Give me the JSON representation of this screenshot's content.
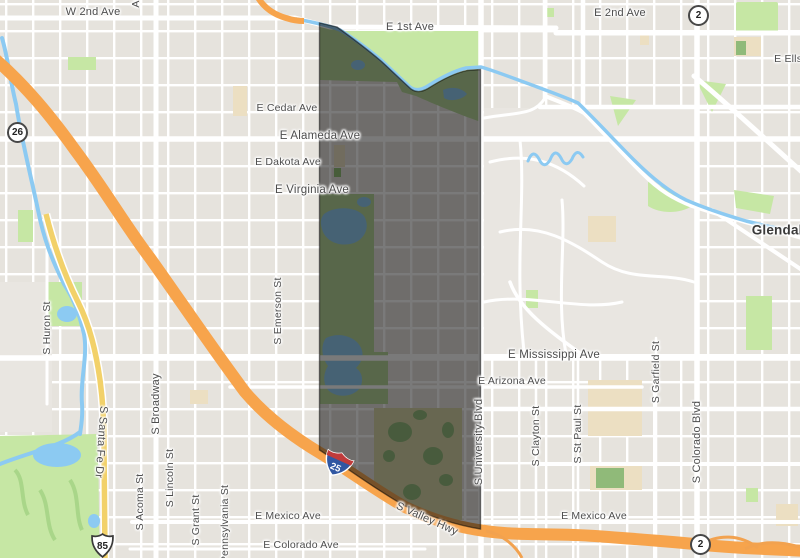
{
  "map": {
    "region_label": "highlighted neighborhood boundary",
    "colors": {
      "land": "#e6e3dd",
      "road": "#ffffff",
      "park": "#c6e7a4",
      "park_dark": "#b3d594",
      "water": "#8ccaf2",
      "highway_orange": "#f7a44c",
      "road_yellow": "#f2d169",
      "school_tan": "#ecdfc2",
      "golf_tan": "#d8d4a4",
      "overlay": "#0d0d0d",
      "label_text": "#4d4d4d"
    },
    "shields": {
      "state_26": {
        "number": "26"
      },
      "state_2_north": {
        "number": "2"
      },
      "state_2_south": {
        "number": "2"
      },
      "us_85": {
        "number": "85"
      },
      "interstate_25": {
        "number": "25"
      }
    },
    "labels": [
      {
        "t": "W 2nd Ave",
        "x": 93,
        "y": 12,
        "r": 0,
        "s": 11
      },
      {
        "t": "Acoma St",
        "x": 136,
        "y": -16,
        "r": -90,
        "s": 10.5
      },
      {
        "t": "E 1st Ave",
        "x": 410,
        "y": 27,
        "r": 0,
        "s": 11
      },
      {
        "t": "E 2nd Ave",
        "x": 620,
        "y": 13,
        "r": 0,
        "s": 11
      },
      {
        "t": "E Ellsworth Ave",
        "x": 812,
        "y": 59,
        "r": 0,
        "s": 10.5
      },
      {
        "t": "E Cedar Ave",
        "x": 287,
        "y": 108,
        "r": 0,
        "s": 10.5
      },
      {
        "t": "E Cedar Ave",
        "x": 832,
        "y": 107,
        "r": 0,
        "s": 10.5
      },
      {
        "t": "E Alameda Ave",
        "x": 320,
        "y": 136,
        "r": 0,
        "s": 11.5
      },
      {
        "t": "E Dakota Ave",
        "x": 288,
        "y": 162,
        "r": 0,
        "s": 10.5
      },
      {
        "t": "E Virginia Ave",
        "x": 312,
        "y": 190,
        "r": 0,
        "s": 11.5
      },
      {
        "t": "Glendale",
        "x": 781,
        "y": 230,
        "r": 0,
        "s": 13.5,
        "w": "bold",
        "c": "#3a3a3a"
      },
      {
        "t": "E Mississippi Ave",
        "x": 554,
        "y": 355,
        "r": 0,
        "s": 11.5
      },
      {
        "t": "E Arizona Ave",
        "x": 512,
        "y": 381,
        "r": 0,
        "s": 10.5
      },
      {
        "t": "E Mexico Ave",
        "x": 288,
        "y": 516,
        "r": 0,
        "s": 10.5
      },
      {
        "t": "E Mexico Ave",
        "x": 594,
        "y": 516,
        "r": 0,
        "s": 10.5
      },
      {
        "t": "E Colorado Ave",
        "x": 301,
        "y": 545,
        "r": 0,
        "s": 10.5
      },
      {
        "t": "S Valley Hwy",
        "x": 427,
        "y": 519,
        "r": 24,
        "s": 11
      },
      {
        "t": "S Huron St",
        "x": 47,
        "y": 328,
        "r": -90,
        "s": 10.5
      },
      {
        "t": "S Santa Fe Dr",
        "x": 101,
        "y": 442,
        "r": 94,
        "s": 11
      },
      {
        "t": "S Broadway",
        "x": 156,
        "y": 404,
        "r": -90,
        "s": 11
      },
      {
        "t": "S Acoma St",
        "x": 140,
        "y": 502,
        "r": -90,
        "s": 10.5
      },
      {
        "t": "S Lincoln St",
        "x": 170,
        "y": 478,
        "r": -90,
        "s": 10.5
      },
      {
        "t": "S Grant St",
        "x": 196,
        "y": 520,
        "r": -90,
        "s": 10.5
      },
      {
        "t": "Pennsylvania St",
        "x": 225,
        "y": 524,
        "r": -90,
        "s": 10.5
      },
      {
        "t": "S Emerson St",
        "x": 278,
        "y": 311,
        "r": -90,
        "s": 10.5
      },
      {
        "t": "S University Blvd",
        "x": 479,
        "y": 442,
        "r": -90,
        "s": 11
      },
      {
        "t": "S Clayton St",
        "x": 536,
        "y": 436,
        "r": -90,
        "s": 10.5
      },
      {
        "t": "S St Paul St",
        "x": 578,
        "y": 434,
        "r": -90,
        "s": 10.5
      },
      {
        "t": "S Garfield St",
        "x": 656,
        "y": 372,
        "r": -90,
        "s": 10.5
      },
      {
        "t": "S Colorado Blvd",
        "x": 697,
        "y": 442,
        "r": -90,
        "s": 11
      }
    ]
  }
}
